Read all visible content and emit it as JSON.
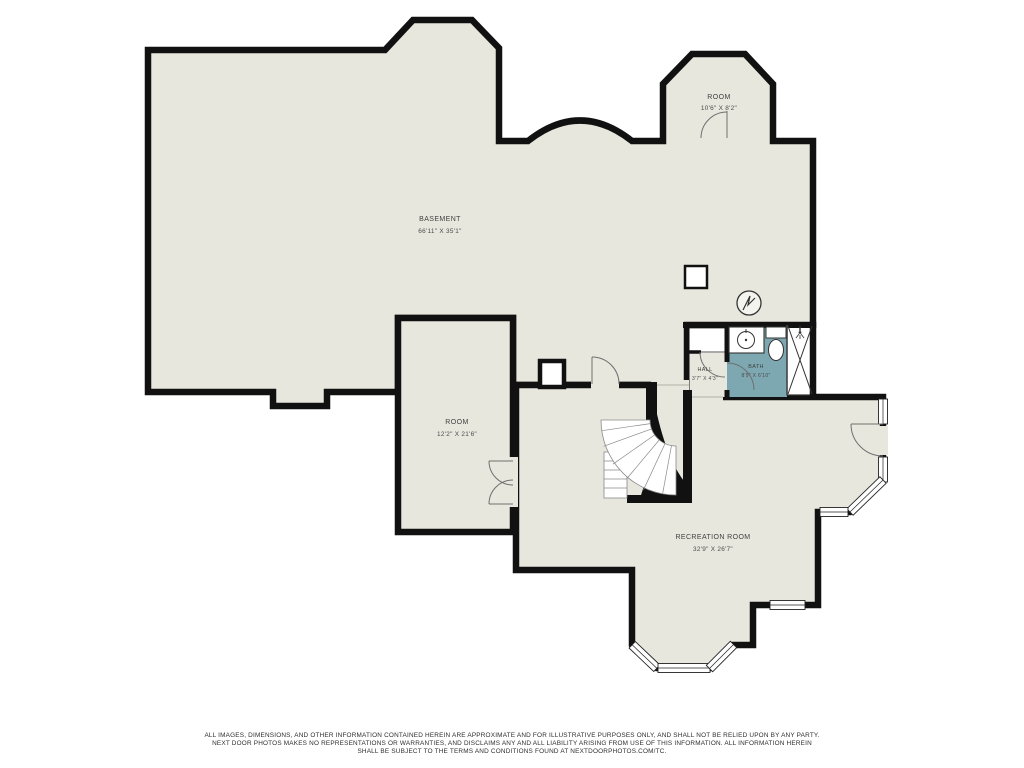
{
  "plan_title": "Basement floor plan",
  "colors": {
    "floor": "#e8e7de",
    "bath_floor": "#7da8b1",
    "wall": "#111111",
    "label_text": "#3f3f3f"
  },
  "rooms": {
    "basement": {
      "name": "BASEMENT",
      "dims": "66'11\" X 35'1\""
    },
    "room_top": {
      "name": "ROOM",
      "dims": "10'6\" X 8'2\""
    },
    "room_left": {
      "name": "ROOM",
      "dims": "12'2\" X 21'6\""
    },
    "hall": {
      "name": "HALL",
      "dims": "3'7\" X 4'3\""
    },
    "bath": {
      "name": "BATH",
      "dims": "8'9\" X 6'10\""
    },
    "recreation": {
      "name": "RECREATION ROOM",
      "dims": "32'9\" X 26'7\""
    }
  },
  "fixtures": [
    "curved-staircase",
    "sink-icon",
    "toilet-icon",
    "shower-icon",
    "water-heater-icon",
    "support-column",
    "duct-chase",
    "door-swing-icon",
    "window-icon"
  ],
  "disclaimer": {
    "line1": "ALL IMAGES, DIMENSIONS, AND OTHER INFORMATION CONTAINED HEREIN ARE APPROXIMATE AND FOR ILLUSTRATIVE PURPOSES ONLY, AND SHALL NOT BE RELIED UPON BY ANY PARTY.",
    "line2": "NEXT DOOR PHOTOS MAKES NO REPRESENTATIONS OR WARRANTIES, AND DISCLAIMS ANY AND ALL LIABILITY ARISING FROM USE OF THIS INFORMATION. ALL INFORMATION HEREIN",
    "line3": "SHALL BE SUBJECT TO THE TERMS AND CONDITIONS FOUND AT NEXTDOORPHOTOS.COM/TC."
  }
}
